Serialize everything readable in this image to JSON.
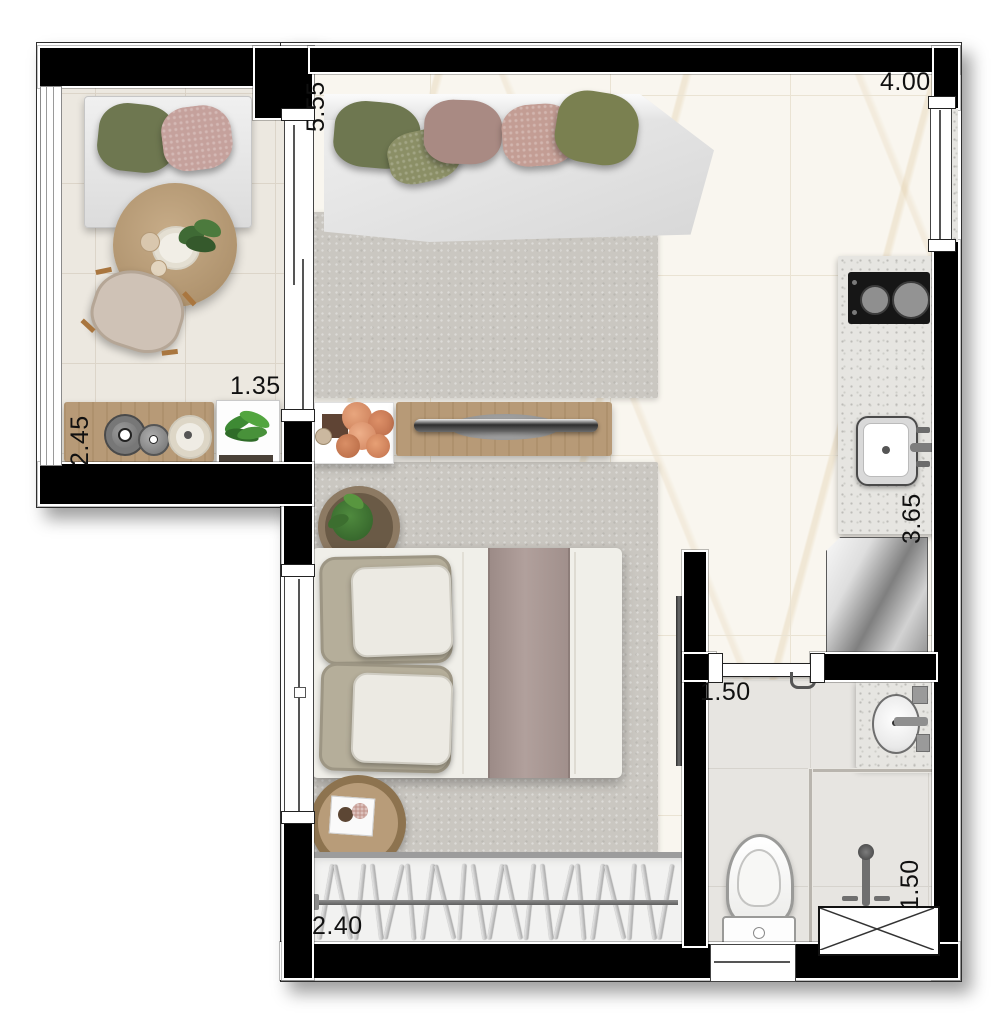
{
  "plan": {
    "labels": {
      "living_length": "5.55",
      "living_width": "4.00",
      "balcony_width": "1.35",
      "balcony_length": "2.45",
      "kitchen_run": "3.65",
      "bath_width": "1.50",
      "shower_width": "1.50",
      "closet_width": "2.40"
    },
    "colors": {
      "wall": "#000000",
      "wood": "#b79a77",
      "rug": "#cac7c1",
      "marble_floor": "#f9f6ef",
      "balcony_floor": "#ece8e0",
      "bath_floor": "#e7e5e1",
      "sofa": "#e9e9e9",
      "pillow_green": "#6e7750",
      "pillow_sage": "#8b8f66",
      "pillow_mauve": "#a98a83",
      "pillow_rose": "#c39d94",
      "bed_throw": "#a89793",
      "bed_duvet": "#f0efe9"
    },
    "closet": {
      "hanger_count": 21
    }
  }
}
